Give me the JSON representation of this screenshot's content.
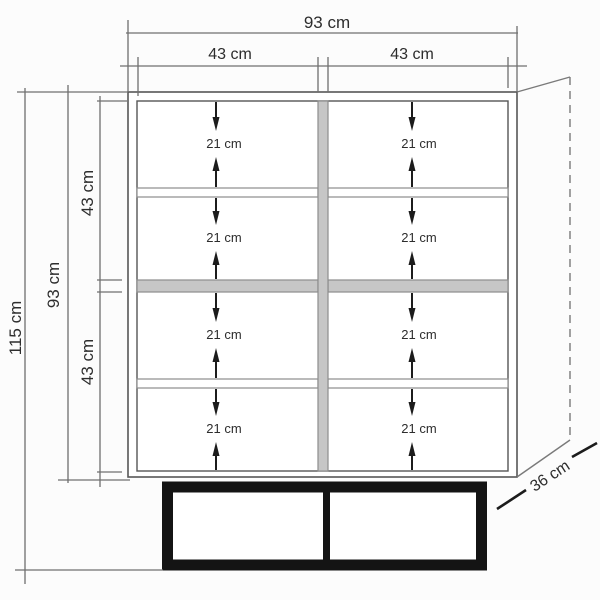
{
  "figure": {
    "type": "furniture-dimension-diagram",
    "width_total": "93 cm",
    "width_left": "43 cm",
    "width_right": "43 cm",
    "height_total": "115 cm",
    "height_body": "93 cm",
    "height_upper": "43 cm",
    "height_lower": "43 cm",
    "depth": "36 cm",
    "compartments": [
      {
        "row": 1,
        "col": "left",
        "label": "21 cm"
      },
      {
        "row": 1,
        "col": "right",
        "label": "21 cm"
      },
      {
        "row": 2,
        "col": "left",
        "label": "21 cm"
      },
      {
        "row": 2,
        "col": "right",
        "label": "21 cm"
      },
      {
        "row": 3,
        "col": "left",
        "label": "21 cm"
      },
      {
        "row": 3,
        "col": "right",
        "label": "21 cm"
      },
      {
        "row": 4,
        "col": "left",
        "label": "21 cm"
      },
      {
        "row": 4,
        "col": "right",
        "label": "21 cm"
      }
    ],
    "colors": {
      "background": "#fcfcfc",
      "cabinet_line": "#565656",
      "dimension_line": "#6f6f6f",
      "shelf_fill": "#c6c6c6",
      "shelf_border": "#8d8d8d",
      "base": "#141414",
      "arrow": "#1c1c1c",
      "text": "#2d2d2d"
    }
  }
}
